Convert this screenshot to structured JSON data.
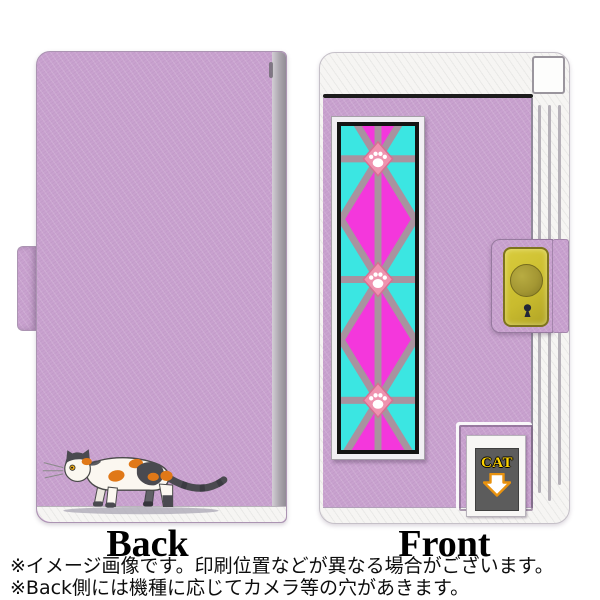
{
  "views": {
    "back": {
      "label": "Back"
    },
    "front": {
      "label": "Front",
      "sign_text": "CAT"
    }
  },
  "notes": {
    "line1": "※イメージ画像です。印刷位置などが異なる場合がございます。",
    "line2": "※Back側には機種に応じてカメラ等の穴があきます。"
  },
  "icons": {
    "panel_medallion": "paw-print",
    "sign_arrow": "arrow-down",
    "clasp_keyhole": "keyhole",
    "back_artwork": "calico-cat-walking"
  },
  "colors": {
    "lilac": "#C9A2CF",
    "lilac_dark": "#AB94B2",
    "spine_gray": "#ABA6AE",
    "white_trim": "#F6F5F3",
    "line_black": "#1C1C1C",
    "magenta": "#F437DC",
    "cyan": "#3BE6E2",
    "lattice": "#A8939F",
    "lattice_light": "#CDC2CA",
    "paw_pink": "#EF93AF",
    "paw_border": "#D76F92",
    "clasp_yellow": "#C9BB2E",
    "clasp_border": "#7D731D",
    "clasp_button": "#A49733",
    "sign_gray": "#5C5C5C",
    "sign_yellow": "#FFD400",
    "arrow_orange": "#E8920F",
    "cat_orange": "#E07818",
    "cat_dark": "#4A4A50",
    "cat_white": "#FBF7F0"
  }
}
